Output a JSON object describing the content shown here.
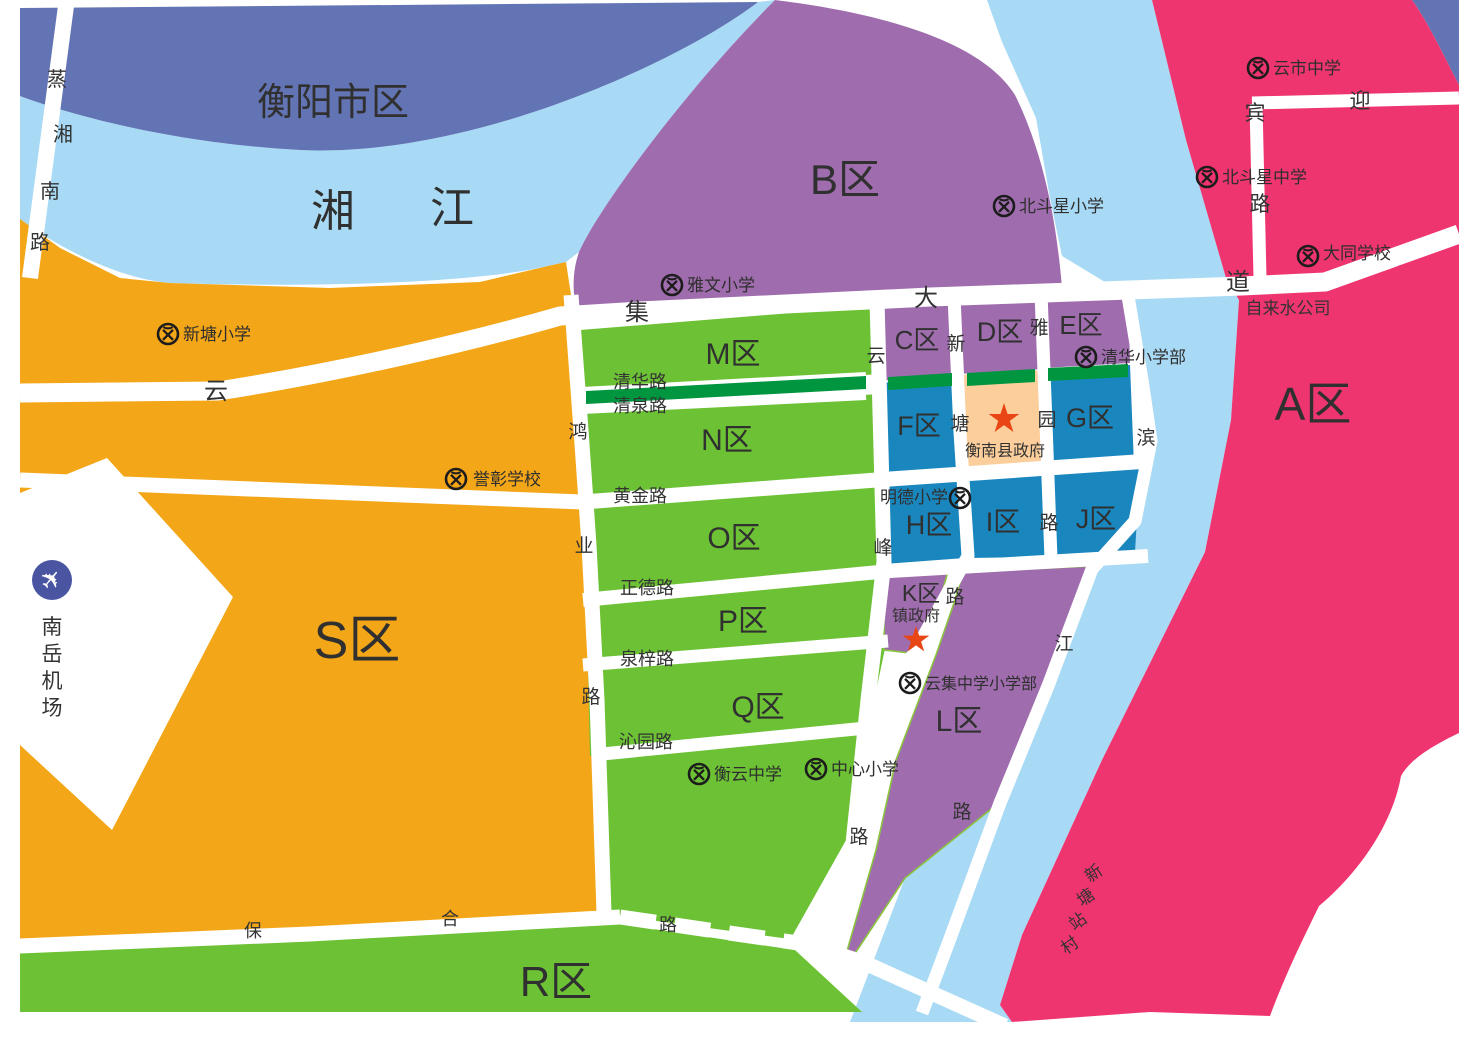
{
  "regions": {
    "hengyang_city": {
      "label": "衡阳市区"
    },
    "xiang_river": {
      "name": "湘江",
      "chars": [
        "湘",
        "江"
      ]
    }
  },
  "zones": {
    "a": {
      "label": "A区"
    },
    "b": {
      "label": "B区"
    },
    "c": {
      "label": "C区"
    },
    "d": {
      "label": "D区"
    },
    "e": {
      "label": "E区"
    },
    "f": {
      "label": "F区"
    },
    "g": {
      "label": "G区"
    },
    "h": {
      "label": "H区"
    },
    "i": {
      "label": "I区"
    },
    "j": {
      "label": "J区"
    },
    "k": {
      "label": "K区"
    },
    "l": {
      "label": "L区"
    },
    "m": {
      "label": "M区"
    },
    "n": {
      "label": "N区"
    },
    "o": {
      "label": "O区"
    },
    "p": {
      "label": "P区"
    },
    "q": {
      "label": "Q区"
    },
    "r": {
      "label": "R区"
    },
    "s": {
      "label": "S区"
    }
  },
  "roads": {
    "zhengxiang_nan": {
      "name": "蒸湘南路",
      "chars": [
        "蒸",
        "湘",
        "南",
        "路"
      ]
    },
    "yunji_avenue": {
      "name": "云集大道",
      "chars": [
        "云",
        "集",
        "大",
        "道"
      ]
    },
    "yingbin": {
      "name": "迎宾路",
      "chars": [
        "迎",
        "宾",
        "路"
      ]
    },
    "qinghua": {
      "label": "清华路"
    },
    "qingquan": {
      "label": "清泉路"
    },
    "huangjin": {
      "label": "黄金路"
    },
    "zhengde": {
      "label": "正德路"
    },
    "quanzi": {
      "label": "泉梓路"
    },
    "qinyuan": {
      "label": "沁园路"
    },
    "baohe": {
      "name": "保合路",
      "chars": [
        "保",
        "合",
        "路"
      ]
    },
    "hongye": {
      "name": "鸿业路",
      "chars": [
        "鸿",
        "业",
        "路"
      ]
    },
    "yunfeng": {
      "name": "云峰路",
      "chars": [
        "云",
        "峰",
        "路"
      ]
    },
    "xintang": {
      "name": "新塘路",
      "chars": [
        "新",
        "塘",
        "路"
      ]
    },
    "yayuan": {
      "name": "雅园路",
      "chars": [
        "雅",
        "园",
        "路"
      ]
    },
    "binjiang": {
      "name": "滨江路",
      "chars": [
        "滨",
        "江",
        "路"
      ]
    }
  },
  "schools": {
    "xintang_primary": {
      "name": "新塘小学"
    },
    "yawen_primary": {
      "name": "雅文小学"
    },
    "beidouxing_primary": {
      "name": "北斗星小学"
    },
    "yunshi_middle": {
      "name": "云市中学"
    },
    "beidouxing_middle": {
      "name": "北斗星中学"
    },
    "datong_school": {
      "name": "大同学校"
    },
    "qinghua_primary": {
      "name": "清华小学部"
    },
    "yuzhang_school": {
      "name": "誉彰学校"
    },
    "mingde_primary": {
      "name": "明德小学"
    },
    "hengyun_middle": {
      "name": "衡云中学"
    },
    "zhongxin_primary": {
      "name": "中心小学"
    },
    "yunji_middle_primary": {
      "name": "云集中学小学部"
    }
  },
  "landmarks": {
    "county_gov": {
      "name": "衡南县政府"
    },
    "town_gov": {
      "name": "镇政府"
    },
    "water_company": {
      "name": "自来水公司"
    },
    "airport": {
      "name": "南岳机场",
      "chars": [
        "南",
        "岳",
        "机",
        "场"
      ],
      "icon": "✈"
    },
    "xintang_village": {
      "name": "新塘站村",
      "chars": [
        "新",
        "塘",
        "站",
        "村"
      ]
    }
  },
  "colors": {
    "map_bg": "#FFFFFF",
    "road": "#FFFFFF",
    "river_blue": "#A9DAF5",
    "city_blue": "#6374B4",
    "zone_orange": "#F3A617",
    "zone_green": "#6CC234",
    "greenbelt": "#009640",
    "zone_purple": "#9F6CAE",
    "zone_blue": "#1A86BE",
    "zone_pink": "#EF356F",
    "gov_orange": "#FBCE9B",
    "star_red": "#E84614",
    "airport_blue": "#4A55A2",
    "label_dark": "#333333"
  }
}
